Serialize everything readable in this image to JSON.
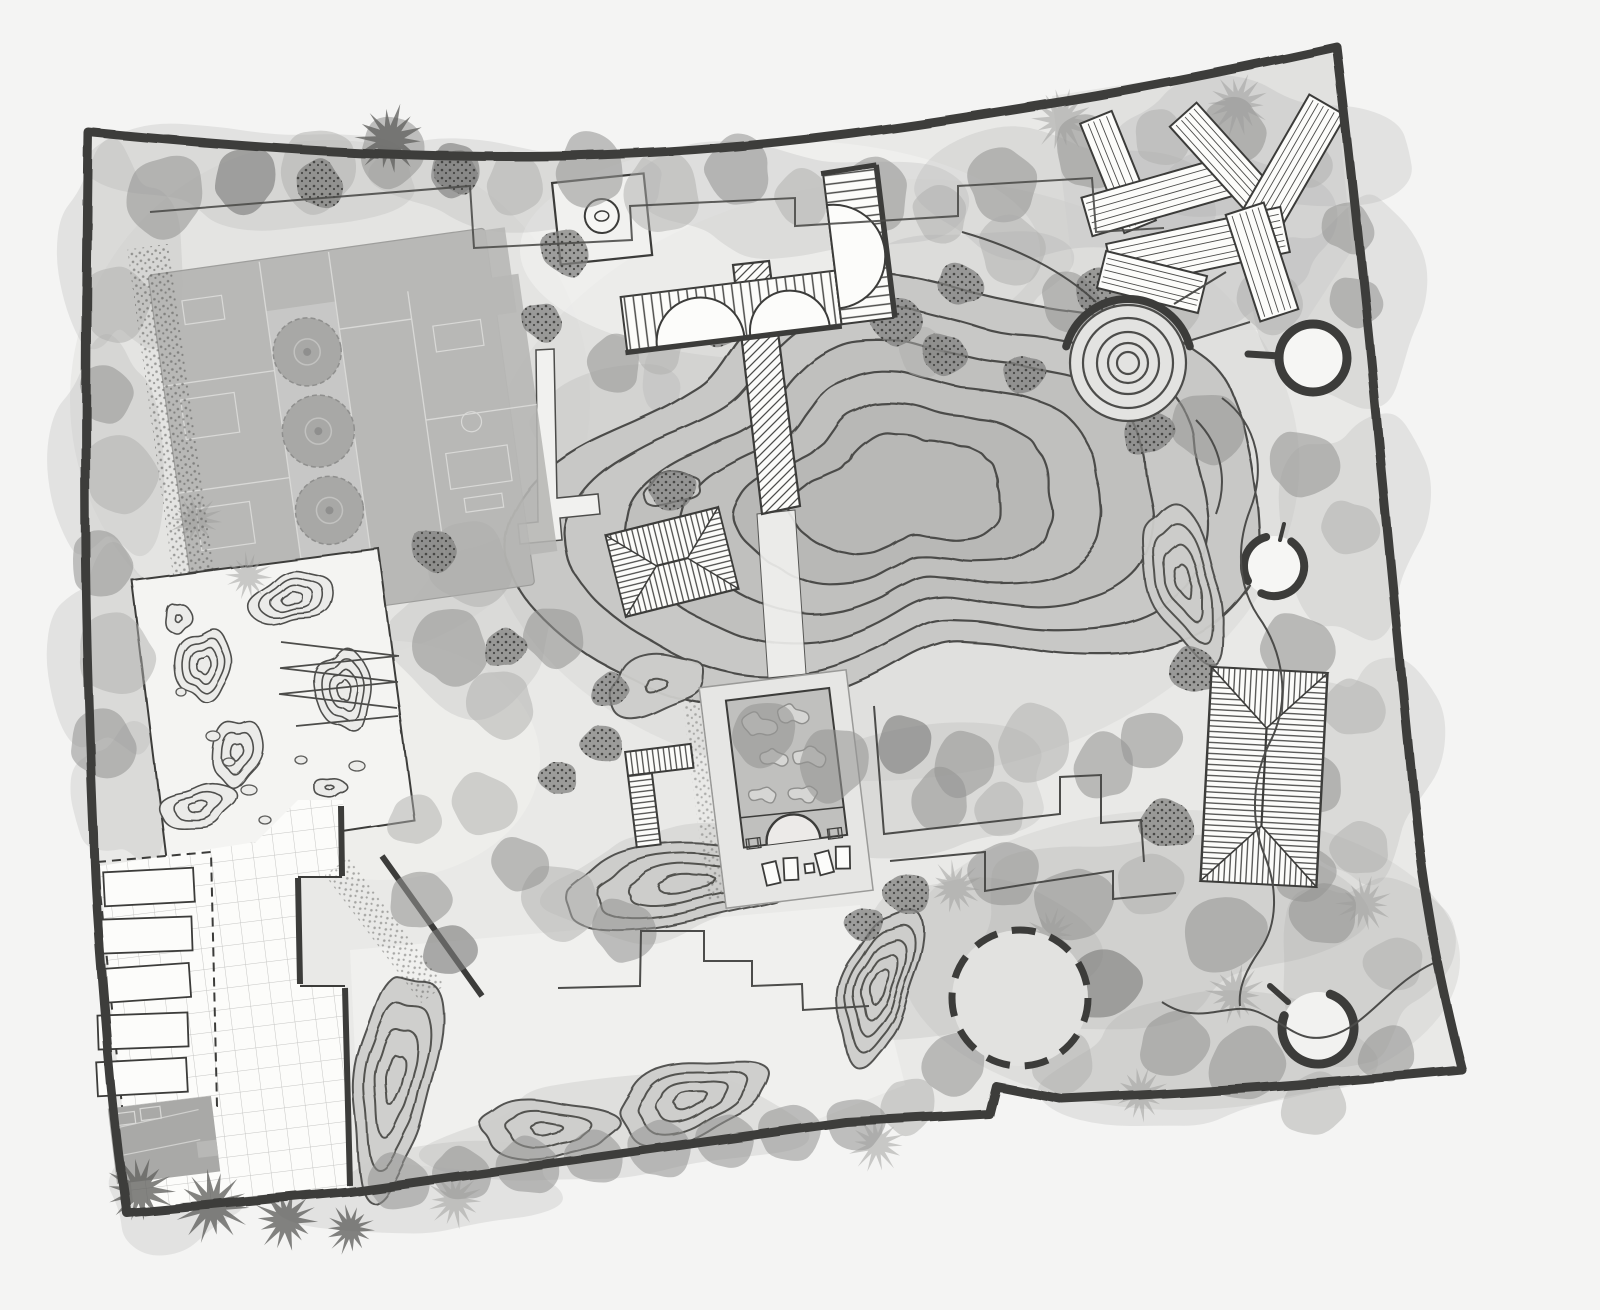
{
  "document": {
    "title": "Hand-drawn garden landscape site plan (grayscale watercolor concept)",
    "visible_text": []
  },
  "palette": {
    "paper": "#f4f4f3",
    "ink": "#3c3c3a",
    "line": "#4c4c4a",
    "wash": "#e9e9e7",
    "washNW": "#dfdfdd",
    "lawn": "#d9d9d7",
    "pale": "#f1f1ef",
    "washSE": "#d3d3d1",
    "pondFill": "#c8c8c6",
    "pondMid": "#c0c0be",
    "pondDeep": "#b8b8b6",
    "white": "#fcfcfa",
    "building": "#b6b6b4",
    "buildingLight": "#c6c6c4",
    "buildingDark": "#a9a9a7",
    "roomLine": "#d8d8d6",
    "gridLine": "#c6c6c4",
    "treeLight": "#adadab",
    "treeMid": "#949492",
    "treeDark": "#7c7c7a",
    "shrub": "#828280",
    "palmLight": "#9b9b99",
    "palmDark": "#646462",
    "speckDot": "#3f3f3d",
    "bermFill": "#cdcdcb",
    "zenFill": "#ebebe9",
    "stone": "#f6f6f4"
  },
  "features": [
    {
      "id": "property-boundary",
      "label": "Thick hand-drawn property boundary wall"
    },
    {
      "id": "residence",
      "label": "Main residence floor plan with furnished rooms"
    },
    {
      "id": "courtyard-trees",
      "label": "Row of three round courtyard trees inside the residence"
    },
    {
      "id": "entry-platform",
      "label": "Square entry platform with round stone basin"
    },
    {
      "id": "curved-pergola",
      "label": "L-shaped pergola with curved slatted canopy"
    },
    {
      "id": "timber-boardwalk",
      "label": "Diagonally hatched timber boardwalk crossing the pond"
    },
    {
      "id": "contour-pond",
      "label": "Large free-form pond with nested depth contour lines"
    },
    {
      "id": "spiral-mound",
      "label": "Spiral earth mound of concentric rings with thick top arc"
    },
    {
      "id": "stone-rings",
      "label": "Three circular stone clearings with heavy ring edges"
    },
    {
      "id": "lawn-circle",
      "label": "Circular lawn clearing with dashed edge"
    },
    {
      "id": "deck-planks",
      "label": "Criss-crossed timber deck planks in north-east corner"
    },
    {
      "id": "pavilion-large",
      "label": "Large hip-roof pavilion, east garden"
    },
    {
      "id": "pavilion-small",
      "label": "Small hip-roof pavilion at pond edge"
    },
    {
      "id": "l-bench",
      "label": "L-shaped slatted bench screen"
    },
    {
      "id": "reflecting-basin",
      "label": "Rectangular basin with rock arrangement and arched footbridge"
    },
    {
      "id": "stepping-stones",
      "label": "Stepping-stone pads below the basin"
    },
    {
      "id": "zen-garden",
      "label": "Dry rock garden panel with contoured moss mounds and pebbles"
    },
    {
      "id": "raised-beds",
      "label": "Five raised planting beds in dashed enclosure"
    },
    {
      "id": "grid-courtyard",
      "label": "Grid-paved service courtyard"
    },
    {
      "id": "utility-structure",
      "label": "Small utility structure in south-west corner"
    },
    {
      "id": "berms",
      "label": "Contoured planting berms"
    },
    {
      "id": "tree-belt",
      "label": "Perimeter tree, shrub and palm belt"
    },
    {
      "id": "paths",
      "label": "Meandering paths, stepped planting edges and ramp"
    }
  ],
  "plan_elements": {
    "pond": {
      "cx": 900,
      "cy": 495,
      "rx": 325,
      "ry": 225,
      "rot": -5,
      "rings": 6
    },
    "spiral": {
      "cx": 1128,
      "cy": 363,
      "rings": [
        58,
        45,
        31,
        20,
        11
      ]
    },
    "circle_features": [
      {
        "id": "stone-ring-north",
        "cx": 1313,
        "cy": 358,
        "r": 34,
        "style": "full"
      },
      {
        "id": "stone-ring-east",
        "cx": 1274,
        "cy": 566,
        "r": 30,
        "style": "broken"
      },
      {
        "id": "stone-ring-south",
        "cx": 1318,
        "cy": 1028,
        "r": 36,
        "style": "arc"
      },
      {
        "id": "lawn-circle",
        "cx": 1020,
        "cy": 998,
        "r": 68,
        "style": "dashed"
      }
    ],
    "berms": [
      {
        "cx": 878,
        "cy": 985,
        "rx": 36,
        "ry": 76,
        "rot": 12,
        "rings": 5
      },
      {
        "cx": 1184,
        "cy": 582,
        "rx": 36,
        "ry": 76,
        "rot": -24,
        "rings": 4
      },
      {
        "cx": 395,
        "cy": 1078,
        "rx": 42,
        "ry": 105,
        "rot": 6,
        "rings": 4
      },
      {
        "cx": 545,
        "cy": 1128,
        "rx": 72,
        "ry": 27,
        "rot": 4,
        "rings": 3
      },
      {
        "cx": 690,
        "cy": 1100,
        "rx": 82,
        "ry": 35,
        "rot": -12,
        "rings": 4
      },
      {
        "cx": 686,
        "cy": 884,
        "rx": 140,
        "ry": 36,
        "rot": -5,
        "rings": 4
      },
      {
        "cx": 655,
        "cy": 684,
        "rx": 54,
        "ry": 26,
        "rot": -14,
        "rings": 2
      },
      {
        "cx": 672,
        "cy": 489,
        "rx": 32,
        "ry": 14,
        "rot": -10,
        "rings": 1
      }
    ],
    "zen_mounds": [
      {
        "cx": 292,
        "cy": 598,
        "rx": 40,
        "ry": 26,
        "rot": -18,
        "rings": 4
      },
      {
        "cx": 203,
        "cy": 664,
        "rx": 26,
        "ry": 38,
        "rot": 12,
        "rings": 4
      },
      {
        "cx": 344,
        "cy": 690,
        "rx": 26,
        "ry": 44,
        "rot": -6,
        "rings": 4
      },
      {
        "cx": 237,
        "cy": 752,
        "rx": 22,
        "ry": 36,
        "rot": 16,
        "rings": 3
      },
      {
        "cx": 197,
        "cy": 806,
        "rx": 36,
        "ry": 22,
        "rot": -14,
        "rings": 3
      },
      {
        "cx": 330,
        "cy": 788,
        "rx": 15,
        "ry": 10,
        "rot": 0,
        "rings": 2
      },
      {
        "cx": 177,
        "cy": 617,
        "rx": 12,
        "ry": 16,
        "rot": 0,
        "rings": 2
      }
    ],
    "zen_pebbles": [
      [
        213,
        736,
        7,
        5
      ],
      [
        229,
        762,
        6,
        4
      ],
      [
        249,
        790,
        8,
        5
      ],
      [
        181,
        692,
        5,
        4
      ],
      [
        301,
        760,
        6,
        4
      ],
      [
        357,
        766,
        8,
        5
      ],
      [
        265,
        820,
        6,
        4
      ]
    ],
    "basin_rocks": [
      [
        766,
        722,
        15
      ],
      [
        801,
        716,
        13
      ],
      [
        777,
        756,
        12
      ],
      [
        813,
        760,
        14
      ],
      [
        763,
        792,
        11
      ],
      [
        803,
        796,
        12
      ],
      [
        783,
        826,
        10
      ]
    ],
    "deck_planks": [
      {
        "cx": 1118,
        "cy": 172,
        "len": 118,
        "wid": 34,
        "rot": 68
      },
      {
        "cx": 1160,
        "cy": 196,
        "len": 152,
        "wid": 40,
        "rot": -16
      },
      {
        "cx": 1224,
        "cy": 160,
        "len": 122,
        "wid": 36,
        "rot": 48
      },
      {
        "cx": 1290,
        "cy": 170,
        "len": 150,
        "wid": 42,
        "rot": -60
      },
      {
        "cx": 1198,
        "cy": 248,
        "len": 178,
        "wid": 46,
        "rot": -12
      },
      {
        "cx": 1262,
        "cy": 262,
        "len": 112,
        "wid": 40,
        "rot": 72
      },
      {
        "cx": 1152,
        "cy": 282,
        "len": 104,
        "wid": 38,
        "rot": 14
      }
    ],
    "forest_wash": [
      [
        260,
        175,
        150,
        55
      ],
      [
        520,
        185,
        130,
        50
      ],
      [
        800,
        200,
        150,
        60
      ],
      [
        1060,
        195,
        130,
        70
      ],
      [
        1255,
        150,
        130,
        75
      ],
      [
        118,
        255,
        55,
        115
      ],
      [
        108,
        455,
        50,
        125
      ],
      [
        108,
        655,
        50,
        115
      ],
      [
        125,
        795,
        45,
        75
      ],
      [
        1345,
        305,
        75,
        115
      ],
      [
        1355,
        525,
        65,
        125
      ],
      [
        1365,
        765,
        65,
        125
      ],
      [
        1360,
        965,
        75,
        105
      ],
      [
        1150,
        925,
        175,
        105
      ],
      [
        960,
        955,
        115,
        85
      ],
      [
        1205,
        1060,
        145,
        70
      ],
      [
        620,
        1130,
        170,
        55
      ],
      [
        430,
        1190,
        130,
        45
      ],
      [
        900,
        795,
        155,
        65
      ],
      [
        650,
        885,
        95,
        55
      ],
      [
        480,
        625,
        85,
        85
      ],
      [
        605,
        420,
        75,
        55
      ],
      [
        955,
        285,
        115,
        55
      ],
      [
        185,
        1185,
        85,
        55
      ],
      [
        1230,
        240,
        110,
        80
      ],
      [
        1120,
        390,
        90,
        70
      ],
      [
        720,
        360,
        90,
        50
      ]
    ],
    "trees": {
      "canopies": [
        [
          165,
          196,
          40,
          "m"
        ],
        [
          245,
          180,
          32,
          "d"
        ],
        [
          318,
          170,
          40,
          "l"
        ],
        [
          392,
          152,
          34,
          "m"
        ],
        [
          455,
          170,
          26,
          "d"
        ],
        [
          515,
          184,
          30,
          "l"
        ],
        [
          590,
          170,
          36,
          "m"
        ],
        [
          662,
          192,
          40,
          "l"
        ],
        [
          738,
          170,
          34,
          "m"
        ],
        [
          802,
          198,
          28,
          "l"
        ],
        [
          874,
          194,
          36,
          "m"
        ],
        [
          940,
          214,
          28,
          "l"
        ],
        [
          1002,
          184,
          36,
          "m"
        ],
        [
          1012,
          250,
          34,
          "l"
        ],
        [
          1070,
          302,
          30,
          "m"
        ],
        [
          1090,
          152,
          36,
          "m"
        ],
        [
          1162,
          138,
          28,
          "l"
        ],
        [
          1234,
          130,
          32,
          "m"
        ],
        [
          1304,
          160,
          28,
          "l"
        ],
        [
          1348,
          228,
          26,
          "m"
        ],
        [
          1170,
          304,
          30,
          "l"
        ],
        [
          1208,
          428,
          36,
          "m"
        ],
        [
          1270,
          302,
          32,
          "l"
        ],
        [
          1356,
          302,
          26,
          "m"
        ],
        [
          1304,
          464,
          34,
          "m"
        ],
        [
          1350,
          528,
          28,
          "l"
        ],
        [
          1297,
          648,
          36,
          "m"
        ],
        [
          1354,
          708,
          30,
          "l"
        ],
        [
          1307,
          784,
          34,
          "m"
        ],
        [
          1360,
          848,
          28,
          "l"
        ],
        [
          1324,
          914,
          32,
          "m"
        ],
        [
          1394,
          964,
          28,
          "l"
        ],
        [
          1004,
          874,
          34,
          "m"
        ],
        [
          1074,
          904,
          38,
          "m"
        ],
        [
          1150,
          884,
          32,
          "l"
        ],
        [
          1224,
          934,
          40,
          "m"
        ],
        [
          1104,
          984,
          36,
          "d"
        ],
        [
          1174,
          1044,
          34,
          "m"
        ],
        [
          1247,
          1064,
          38,
          "m"
        ],
        [
          1314,
          1104,
          32,
          "l"
        ],
        [
          1387,
          1054,
          28,
          "m"
        ],
        [
          1064,
          1064,
          30,
          "l"
        ],
        [
          954,
          1064,
          32,
          "m"
        ],
        [
          908,
          1106,
          28,
          "l"
        ],
        [
          764,
          734,
          32,
          "m"
        ],
        [
          834,
          764,
          36,
          "m"
        ],
        [
          904,
          744,
          28,
          "d"
        ],
        [
          964,
          764,
          32,
          "m"
        ],
        [
          1034,
          744,
          38,
          "l"
        ],
        [
          1104,
          766,
          32,
          "m"
        ],
        [
          940,
          800,
          30,
          "m"
        ],
        [
          1000,
          810,
          26,
          "l"
        ],
        [
          614,
          364,
          28,
          "m"
        ],
        [
          658,
          347,
          26,
          "l"
        ],
        [
          922,
          352,
          24,
          "l"
        ],
        [
          116,
          304,
          36,
          "l"
        ],
        [
          106,
          394,
          28,
          "m"
        ],
        [
          121,
          474,
          38,
          "l"
        ],
        [
          101,
          564,
          32,
          "m"
        ],
        [
          116,
          654,
          40,
          "l"
        ],
        [
          103,
          744,
          34,
          "m"
        ],
        [
          470,
          564,
          42,
          "l"
        ],
        [
          450,
          647,
          38,
          "m"
        ],
        [
          500,
          704,
          34,
          "l"
        ],
        [
          554,
          637,
          30,
          "m"
        ],
        [
          560,
          902,
          38,
          "l"
        ],
        [
          624,
          930,
          32,
          "m"
        ],
        [
          520,
          864,
          28,
          "m"
        ],
        [
          484,
          804,
          32,
          "l"
        ],
        [
          398,
          1182,
          30,
          "m"
        ],
        [
          462,
          1174,
          28,
          "m"
        ],
        [
          528,
          1166,
          30,
          "m"
        ],
        [
          594,
          1157,
          28,
          "m"
        ],
        [
          660,
          1149,
          30,
          "m"
        ],
        [
          726,
          1141,
          28,
          "m"
        ],
        [
          790,
          1133,
          30,
          "m"
        ],
        [
          856,
          1124,
          28,
          "m"
        ],
        [
          1304,
          874,
          30,
          "m"
        ],
        [
          1150,
          740,
          30,
          "m"
        ],
        [
          420,
          900,
          30,
          "m"
        ],
        [
          450,
          950,
          26,
          "d"
        ],
        [
          415,
          820,
          26,
          "l"
        ]
      ],
      "shrubs": [
        [
          320,
          184,
          24
        ],
        [
          456,
          172,
          22
        ],
        [
          565,
          252,
          24
        ],
        [
          542,
          322,
          20
        ],
        [
          434,
          550,
          22
        ],
        [
          895,
          320,
          26
        ],
        [
          944,
          354,
          22
        ],
        [
          717,
          324,
          24
        ],
        [
          960,
          284,
          22
        ],
        [
          1194,
          670,
          24
        ],
        [
          1167,
          824,
          26
        ],
        [
          602,
          744,
          20
        ],
        [
          558,
          778,
          18
        ],
        [
          907,
          894,
          22
        ],
        [
          864,
          924,
          18
        ],
        [
          672,
          490,
          22
        ],
        [
          1024,
          374,
          20
        ],
        [
          1100,
          290,
          24
        ],
        [
          1148,
          432,
          24
        ],
        [
          505,
          648,
          20
        ],
        [
          610,
          690,
          18
        ]
      ],
      "palms": [
        [
          390,
          140,
          34,
          "d"
        ],
        [
          1062,
          120,
          30,
          "l"
        ],
        [
          1238,
          104,
          30,
          "l"
        ],
        [
          140,
          1190,
          32,
          "d"
        ],
        [
          212,
          1206,
          34,
          "d"
        ],
        [
          286,
          1220,
          30,
          "d"
        ],
        [
          350,
          1229,
          24,
          "d"
        ],
        [
          455,
          1200,
          26,
          "l"
        ],
        [
          877,
          1144,
          26,
          "l"
        ],
        [
          955,
          888,
          26,
          "l"
        ],
        [
          1050,
          934,
          24,
          "l"
        ],
        [
          1364,
          904,
          26,
          "l"
        ],
        [
          1235,
          994,
          28,
          "l"
        ],
        [
          1140,
          1094,
          26,
          "l"
        ],
        [
          248,
          576,
          22,
          "l"
        ],
        [
          196,
          520,
          24,
          "l"
        ]
      ]
    }
  }
}
